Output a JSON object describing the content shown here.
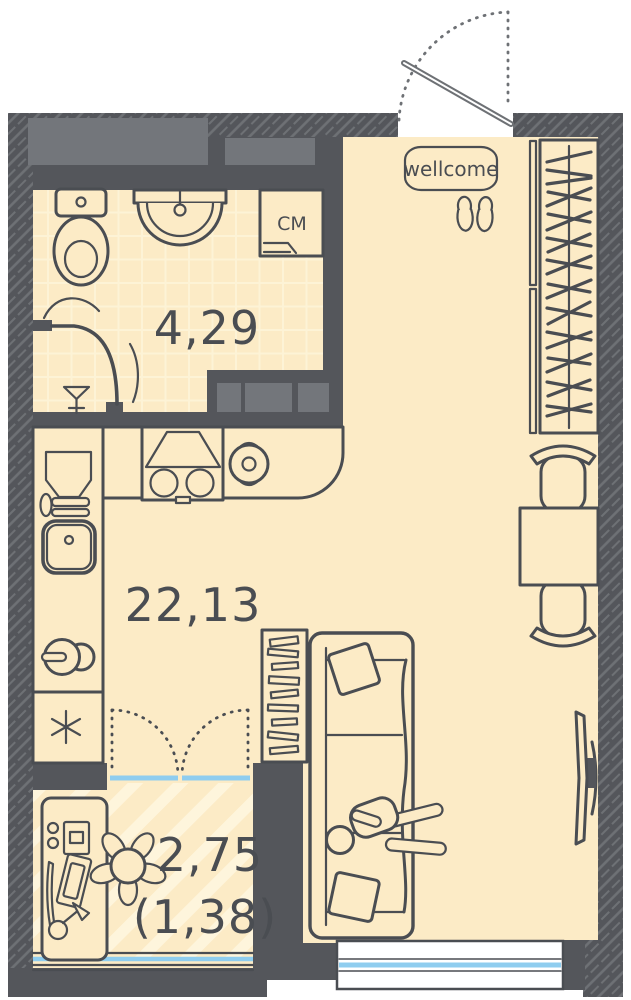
{
  "plan": {
    "entry_sign": "wellcome",
    "washer_label": "СМ",
    "rooms": {
      "bathroom": {
        "area": "4,29"
      },
      "living_kitchen": {
        "area": "22,13"
      },
      "balcony": {
        "area": "2,75",
        "area_coefficient": "(1,38)"
      }
    }
  },
  "colors": {
    "floor": "#FCEBC6",
    "stripe": "#FEF5DC",
    "tile_line": "#FDF3D6",
    "wall": "#54565B",
    "wall_hatch": "#6E7175",
    "shaft": "#73767B",
    "line": "#4A4D52",
    "glass": "#8FCDEF",
    "label": "#4A4D52",
    "white": "#FFFFFF"
  }
}
